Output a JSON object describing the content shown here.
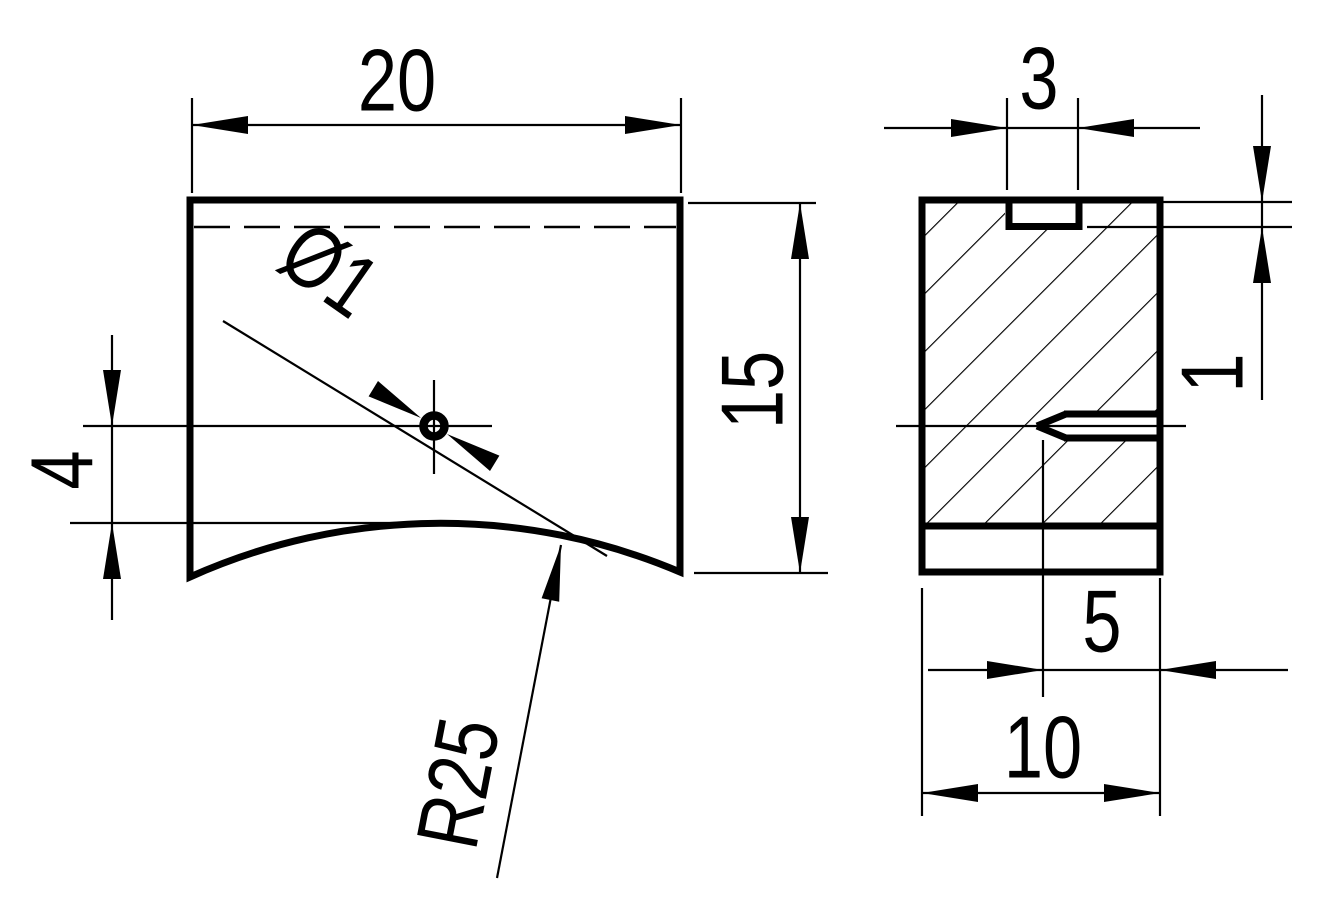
{
  "drawing": {
    "type": "2D engineering drawing, two orthographic views",
    "colors": {
      "line": "#000000",
      "background": "#ffffff"
    },
    "front_view": {
      "description": "block 20 wide x 15 tall, concave R25 bottom, small through hole",
      "dimensions": [
        {
          "id": "width",
          "label": "20",
          "value": 20
        },
        {
          "id": "height",
          "label": "15",
          "value": 15
        },
        {
          "id": "hole-offset-from-arc",
          "label": "4",
          "value": 4
        },
        {
          "id": "hole-diameter",
          "label": "Ø1",
          "value": 1
        },
        {
          "id": "bottom-arc-radius",
          "label": "R25",
          "value": 25
        }
      ]
    },
    "side_section_view": {
      "description": "hatched cross section 10 wide, top slot 3 x 1, side hole drilled 5 deep",
      "dimensions": [
        {
          "id": "slot-width",
          "label": "3",
          "value": 3
        },
        {
          "id": "slot-depth",
          "label": "1",
          "value": 1
        },
        {
          "id": "hole-depth",
          "label": "5",
          "value": 5
        },
        {
          "id": "view-depth",
          "label": "10",
          "value": 10
        }
      ]
    }
  }
}
